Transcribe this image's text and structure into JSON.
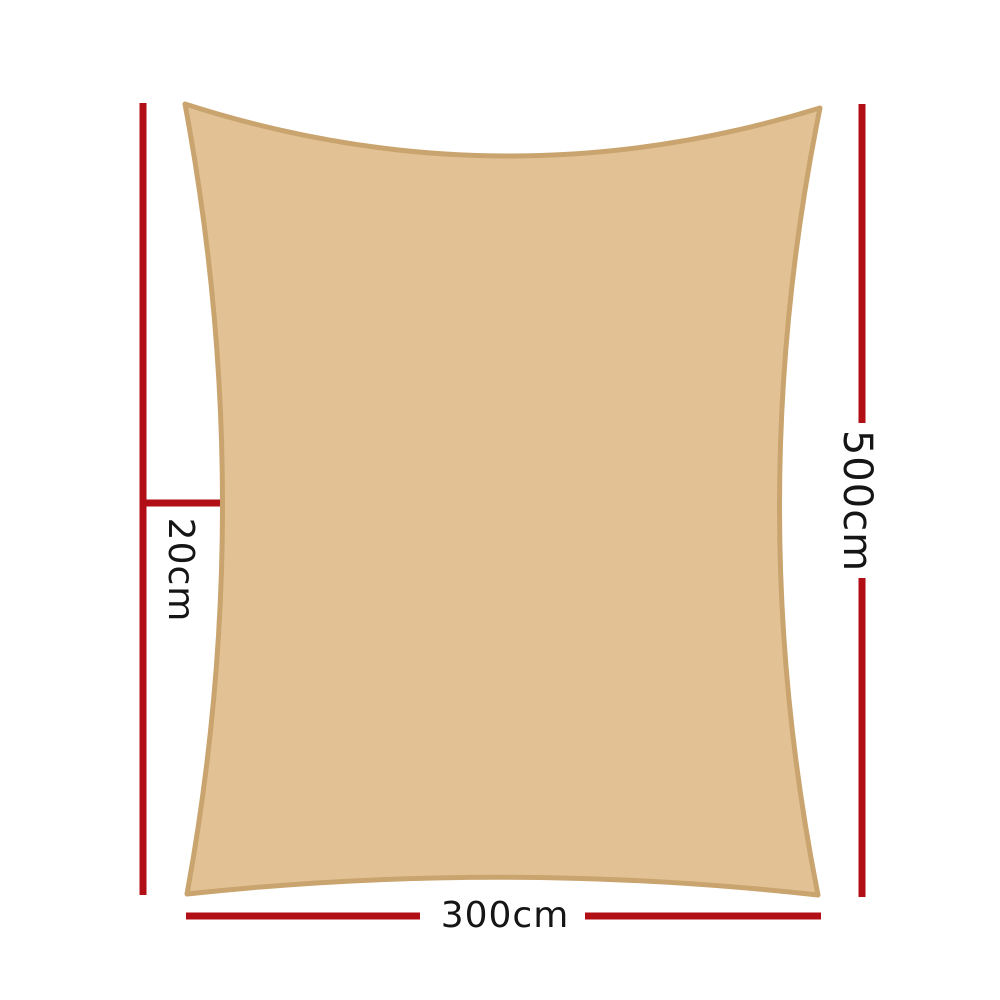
{
  "diagram": {
    "type": "product-dimension-diagram",
    "subject": "rectangle shade sail top view",
    "sail": {
      "fill_color": "#e2c295",
      "edge_color": "#caa46f"
    },
    "dimensions": {
      "height_label": "500cm",
      "width_label": "300cm",
      "curve_depth_label": "20cm"
    },
    "colors": {
      "dimension_line": "#b20e15",
      "label_text": "#151515",
      "background": "#ffffff"
    }
  }
}
